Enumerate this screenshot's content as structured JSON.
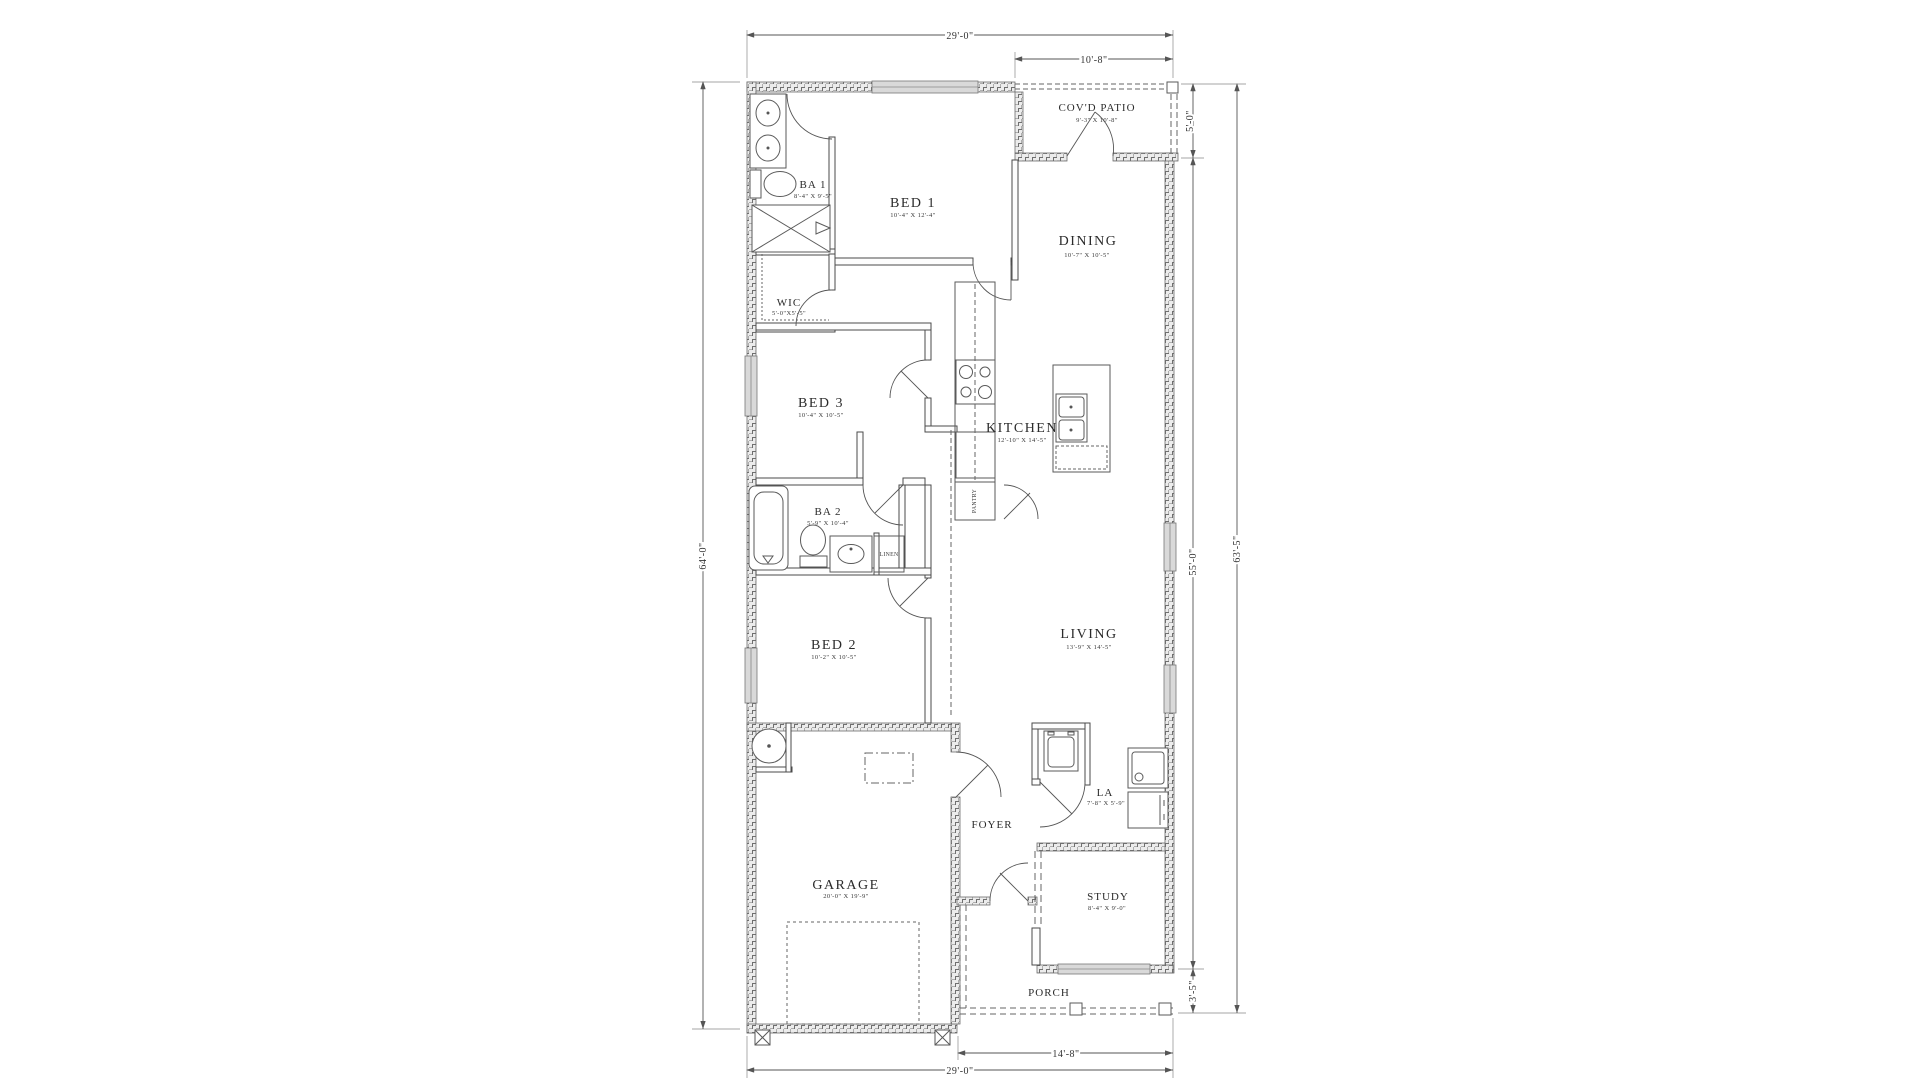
{
  "rooms": {
    "patio": {
      "name": "COV'D PATIO",
      "size": "9'-3\" X 10'-8\""
    },
    "ba1": {
      "name": "BA 1",
      "size": "8'-4\" X 9'-5\""
    },
    "bed1": {
      "name": "BED 1",
      "size": "10'-4\" X 12'-4\""
    },
    "wic": {
      "name": "WIC",
      "size": "5'-0\"X5'-5\""
    },
    "dining": {
      "name": "DINING",
      "size": "10'-7\" X 10'-5\""
    },
    "bed3": {
      "name": "BED 3",
      "size": "10'-4\" X 10'-5\""
    },
    "kitchen": {
      "name": "KITCHEN",
      "size": "12'-10\" X 14'-5\""
    },
    "ba2": {
      "name": "BA 2",
      "size": "5'-9\" X 10'-4\""
    },
    "linen": {
      "name": "LINEN"
    },
    "pantry": {
      "name": "PANTRY"
    },
    "bed2": {
      "name": "BED 2",
      "size": "10'-2\" X 10'-5\""
    },
    "living": {
      "name": "LIVING",
      "size": "13'-9\" X 14'-5\""
    },
    "garage": {
      "name": "GARAGE",
      "size": "20'-0\" X 19'-9\""
    },
    "foyer": {
      "name": "FOYER"
    },
    "la": {
      "name": "LA",
      "size": "7'-8\" X 5'-9\""
    },
    "study": {
      "name": "STUDY",
      "size": "8'-4\" X 9'-0\""
    },
    "porch": {
      "name": "PORCH"
    }
  },
  "dims": {
    "top": "29'-0\"",
    "patio_w": "10'-8\"",
    "patio_d": "5'-0\"",
    "right_main": "55'-0\"",
    "right_porch": "3'-5\"",
    "right_total": "63'-5\"",
    "left_total": "64'-0\"",
    "bottom_porch": "14'-8\"",
    "bottom": "29'-0\""
  }
}
